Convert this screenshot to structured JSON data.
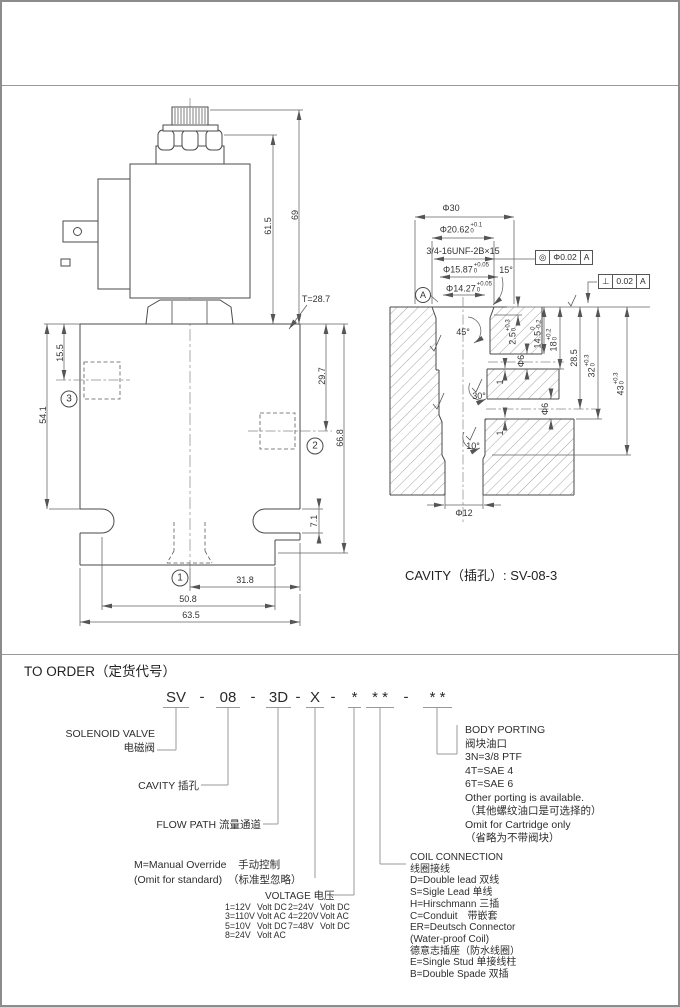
{
  "ld": {
    "t287": "T=28.7",
    "d69": "69",
    "d615": "61.5",
    "d155": "15.5",
    "d541": "54.1",
    "d297": "29.7",
    "d668": "66.8",
    "d71": "7.1",
    "d318": "31.8",
    "d508": "50.8",
    "d635": "63.5",
    "p1": "1",
    "p2": "2",
    "p3": "3"
  },
  "cv": {
    "d30": "Φ30",
    "thread": "3/4-16UNF-2B×15",
    "a15": "15°",
    "a45": "45°",
    "a30": "30°",
    "a10": "10°",
    "n1a": "1",
    "n1b": "1",
    "d6a": "Φ6",
    "d6b": "Φ6",
    "d285": "28.5",
    "d12": "Φ12",
    "t2062": {
      "m": "Φ20.62",
      "u": "+0.1",
      "l": "0"
    },
    "t1587": {
      "m": "Φ15.87",
      "u": "+0.05",
      "l": "0"
    },
    "t1427": {
      "m": "Φ14.27",
      "u": "+0.05",
      "l": "0"
    },
    "t25": {
      "m": "2.5",
      "u": "+0.3",
      "l": "0"
    },
    "t145": {
      "m": "14.5",
      "u": "0",
      "l": "-0.2"
    },
    "t18": {
      "m": "18",
      "u": "+0.2",
      "l": "0"
    },
    "t32": {
      "m": "32",
      "u": "+0.3",
      "l": "0"
    },
    "t43": {
      "m": "43",
      "u": "+0.3",
      "l": "0"
    },
    "gdt1": {
      "sym": "◎",
      "val": "Φ0.02",
      "datum": "A"
    },
    "gdt2": {
      "sym": "⊥",
      "val": "0.02",
      "datum": "A"
    },
    "datum": "A",
    "caption": "CAVITY（插孔）: SV-08-3"
  },
  "order": {
    "section_title": "TO ORDER（定货代号）",
    "dash": "-",
    "code": [
      "SV",
      "08",
      "3D",
      "X",
      "*",
      "* *",
      "* *"
    ],
    "solenoid": {
      "en": "SOLENOID VALVE",
      "zh": "电磁阀"
    },
    "cavity": {
      "en": "CAVITY",
      "zh": "插孔"
    },
    "flow_path": {
      "en": "FLOW PATH",
      "zh": "流量通道"
    },
    "manual": {
      "l1en": "M=Manual Override",
      "l1zh": "手动控制",
      "l2en": "(Omit for standard)",
      "l2zh": "（标准型忽略）"
    },
    "voltage": {
      "title_en": "VOLTAGE",
      "title_zh": "电压",
      "rows": [
        [
          "1=12V",
          "Volt DC"
        ],
        [
          "2=24V",
          "Volt DC"
        ],
        [
          "3=110V",
          "Volt AC"
        ],
        [
          "4=220V",
          "Volt AC"
        ],
        [
          "5=10V",
          "Volt DC"
        ],
        [
          "7=48V",
          "Volt DC"
        ],
        [
          "8=24V",
          "Volt AC"
        ]
      ]
    },
    "coil": {
      "title": "COIL CONNECTION",
      "lines": [
        "线圈接线",
        "D=Double lead 双线",
        "S=Sigle Lead 单线",
        "H=Hirschmann 三插",
        "C=Conduit　带嵌套",
        "ER=Deutsch Connector",
        "(Water-proof Coil)",
        "德意志插座（防水线圈）",
        "E=Single Stud 单接线柱",
        "B=Double Spade 双插"
      ]
    },
    "porting": {
      "title": "BODY PORTING",
      "lines": [
        "阀块油口",
        "3N=3/8  PTF",
        "4T=SAE  4",
        "6T=SAE  6",
        "Other porting is available.",
        "（其他螺纹油口是可选择的）",
        "Omit for Cartridge only",
        "（省略为不带阀块）"
      ]
    }
  }
}
